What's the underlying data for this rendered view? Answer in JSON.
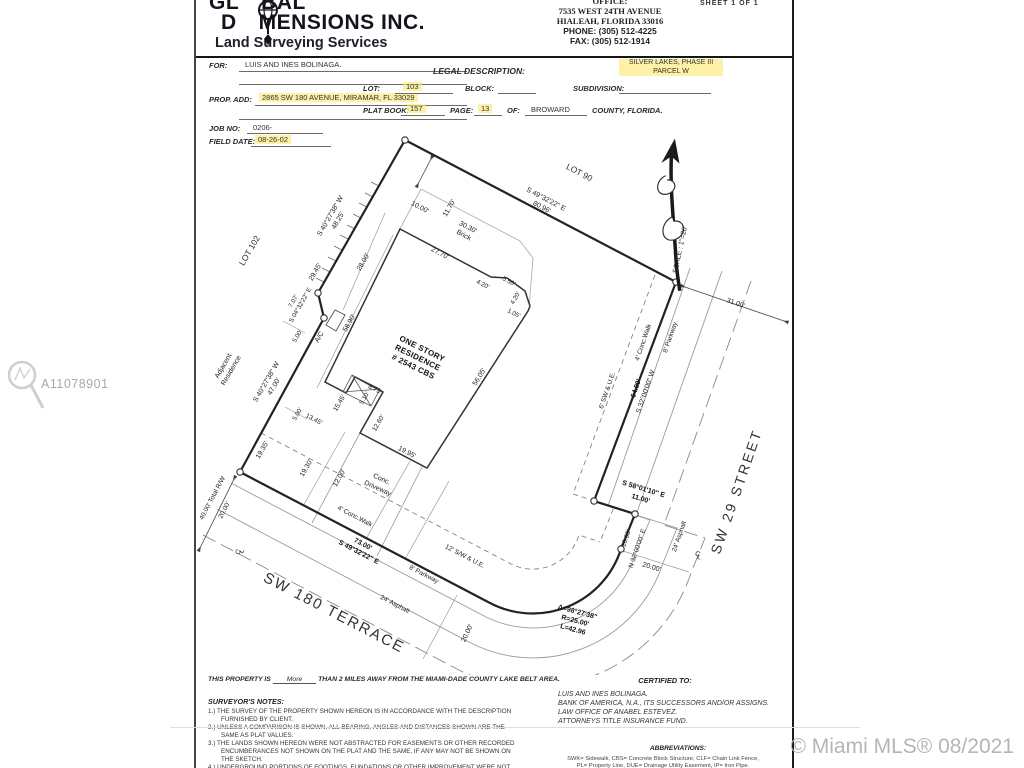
{
  "header": {
    "logo_l1a": "GL",
    "logo_l1b": "BAL",
    "logo_l2a": "D",
    "logo_l2b": "MENSIONS INC.",
    "tagline": "Land Surveying Services",
    "office_label": "OFFICE:",
    "office_addr1": "7535 WEST 24TH AVENUE",
    "office_addr2": "HIALEAH, FLORIDA 33016",
    "phone_label": "PHONE:",
    "phone": "(305) 512-4225",
    "fax_label": "FAX:",
    "fax": "(305) 512-1914",
    "sheet_text": "SHEET  1  OF  1"
  },
  "info": {
    "for_label": "FOR:",
    "for_value": "LUIS AND INES BOLINAGA.",
    "prop_label": "PROP. ADD:",
    "prop_value": "2865 SW 180 AVENUE, MIRAMAR, FL  33029",
    "job_label": "JOB NO:",
    "job_value": "0206-",
    "field_label": "FIELD DATE:",
    "field_value": "08-26-02",
    "legal_label": "LEGAL DESCRIPTION:",
    "lot_label": "LOT:",
    "lot_value": "103",
    "block_label": "BLOCK:",
    "subdivision_label": "SUBDIVISION:",
    "subdivision_value1": "SILVER LAKES, PHASE III",
    "subdivision_value2": "PARCEL  W",
    "platbook_label": "PLAT BOOK:",
    "platbook_value": "157",
    "page_label": "PAGE:",
    "page_value": "13",
    "of_label": "OF:",
    "of_value": "BROWARD",
    "county_label": "COUNTY, FLORIDA."
  },
  "drawing": {
    "lot90": "LOT 90",
    "lot102": "LOT 102",
    "adjacent1": "Adjacent",
    "adjacent2": "Residence",
    "ne_bearing": "S 49°32'22\" E",
    "ne_dist": "80.96'",
    "nw_bearing": "S 40°27'38\" W",
    "nw_dist": "48.25'",
    "w_bearing": "S 40°27'38\" W",
    "w_dist": "47.00'",
    "jog_dist": "7.07'",
    "jog_bearing": "S 04°32'22\" E",
    "d29_45": "29.45'",
    "d5_00": "5.00'",
    "d58_90": "58.90'",
    "d28_00": "28.00'",
    "d10_00": "10.00'",
    "d11_70": "11.70'",
    "d30_30": "30.30'",
    "brick": "Brick",
    "d27_70": "27.70'",
    "d4_20": "4.20'",
    "d5_50": "5.50'",
    "d1_05": "1.05'",
    "d56_05": "56.05'",
    "house1": "ONE STORY",
    "house2": "RESIDENCE",
    "house3": "# 2543  CBS",
    "ac": "A/C",
    "d8_75": "8.75'",
    "d5_10": "5.10'",
    "d12_60": "12.60'",
    "d19_95": "19.95'",
    "d15_45": "15.45'",
    "d13_45": "13.45'",
    "d19_35": "19.35'",
    "d19_30": "19.30'",
    "d12_00": "12.00'",
    "driveway1": "Conc.",
    "driveway2": "Driveway",
    "walk4": "4' Conc.Walk",
    "s_dist": "73.00'",
    "s_bearing": "S 49°32'22\" E",
    "swue12": "12' S/W & U.E.",
    "swue6": "6' SW & U.E.",
    "parkway": "8' Parkway",
    "asphalt": "24' Asphalt",
    "terrace": "SW 180 TERRACE",
    "street29": "SW 29 STREET",
    "rw": "40.00' Total R/W",
    "d20_00": "20.00'",
    "e_dist": "64.00'",
    "e_bearing": "S 32°00'00\" W",
    "d31_00": "31.00'",
    "jog2_bearing": "S 58°01'10\" E",
    "jog2_dist": "11.00'",
    "jog3_bearing": "N 32°00'00\" E",
    "jog3_dist": "10.00'",
    "curve_delta": "Δ=98°27'38\"",
    "curve_r": "R=25.00'",
    "curve_l": "L=42.96",
    "scale": "SCALE : 1\"=20'",
    "cl1": "C",
    "cl2": "L"
  },
  "notes": {
    "prop_a": "THIS PROPERTY IS",
    "prop_more": "More",
    "prop_b": "THAN 2 MILES AWAY FROM THE MIAMI-DADE COUNTY LAKE BELT AREA.",
    "surveyors_title": "SURVEYOR'S NOTES:",
    "n1": "1.) THE SURVEY OF THE PROPERTY SHOWN HEREON IS IN ACCORDANCE WITH THE DESCRIPTION FURNISHED BY CLIENT.",
    "n2": "2.) UNLESS A COMPARISON IS SHOWN, ALL BEARING, ANGLES AND DISTANCES SHOWN ARE THE SAME AS PLAT VALUES.",
    "n3": "3.) THE LANDS SHOWN HEREON WERE NOT ABSTRACTED FOR EASEMENTS OR OTHER RECORDED ENCUMBERANCES NOT SHOWN ON THE PLAT AND THE SAME, IF ANY MAY NOT BE SHOWN ON THE SKETCH.",
    "n4": "4.) UNDERGROUND PORTIONS OF FOOTINGS, FUNDATIONS OR OTHER IMPROVEMENT WERE NOT LOCATED.",
    "certified_title": "CERTIFIED TO:",
    "cert1": "LUIS AND INES BOLINAGA.",
    "cert2": "BANK OF AMERICA, N.A., ITS SUCCESSORS AND/OR ASSIGNS.",
    "cert3": "LAW OFFICE OF ANABEL ESTEVEZ.",
    "cert4": "ATTORNEYS TITLE INSURANCE FUND.",
    "abbrev_title": "ABBREVIATIONS:",
    "abbrev1": "SWK= Sidewalk, CBS= Concrete Block Structure, CLF= Chain Link Fence,",
    "abbrev2": "PL= Property Line, DUE= Drainage Utility Easement, IP= Iron Pipe."
  },
  "watermark": {
    "id": "A11078901",
    "mls": "© Miami MLS® 08/2021"
  },
  "colors": {
    "highlight": "#fae978",
    "boundary": "#222222",
    "watermark": "#b5b5b5"
  }
}
